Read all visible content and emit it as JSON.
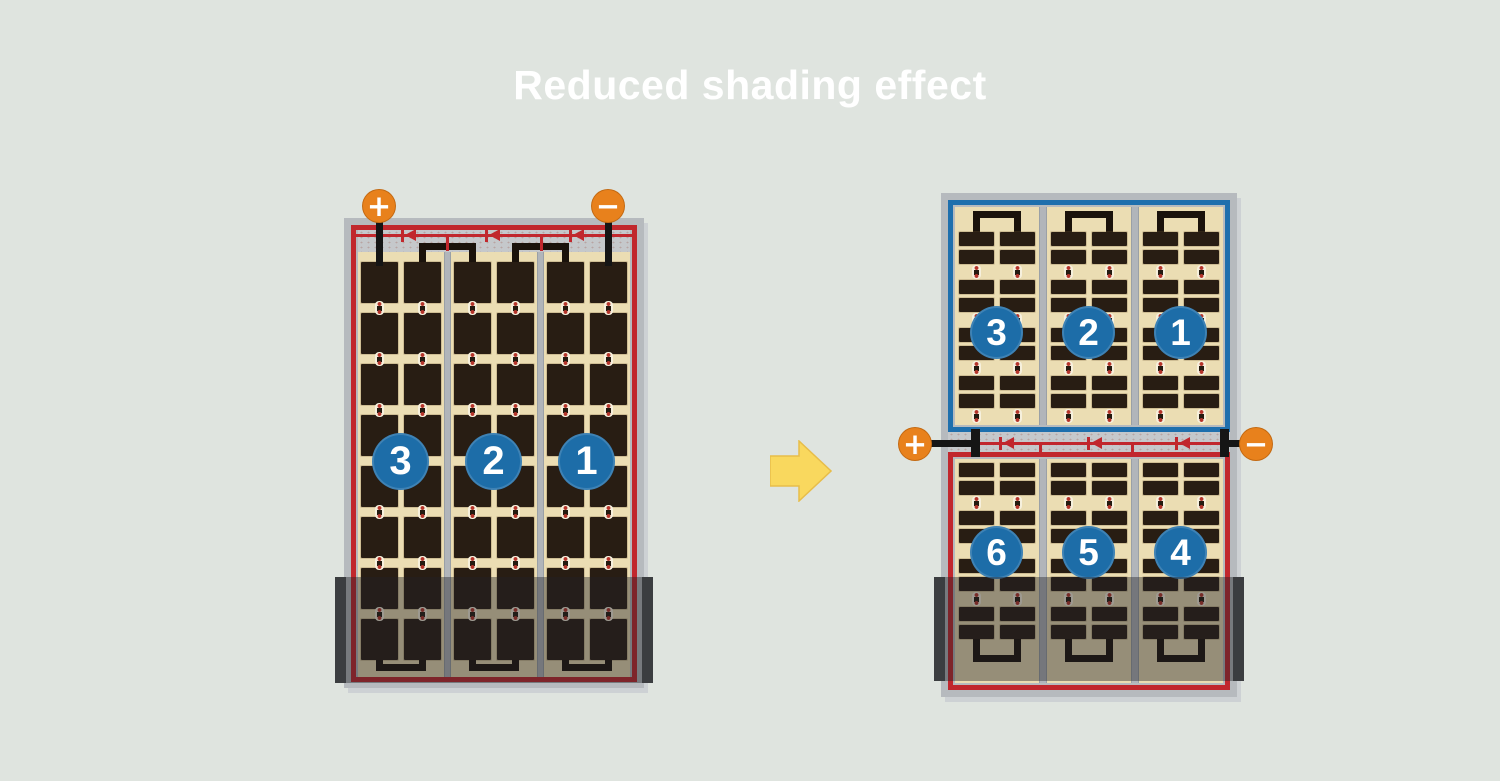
{
  "title": "Reduced shading effect",
  "left_panel": {
    "terminal_positive": "+",
    "terminal_negative": "−",
    "strings": [
      {
        "number": "3"
      },
      {
        "number": "2"
      },
      {
        "number": "1"
      }
    ],
    "shaded_rows": "bottom"
  },
  "right_panel": {
    "terminal_positive": "+",
    "terminal_negative": "−",
    "top_half_strings": [
      {
        "number": "3"
      },
      {
        "number": "2"
      },
      {
        "number": "1"
      }
    ],
    "bottom_half_strings": [
      {
        "number": "6"
      },
      {
        "number": "5"
      },
      {
        "number": "4"
      }
    ],
    "shaded_rows": "bottom"
  },
  "colors": {
    "background": "#dfe4df",
    "title_color": "#ffffff",
    "frame": "#b6babe",
    "strip": "#c5c8cb",
    "cream": "#ebddb3",
    "cell": "#281d13",
    "busbar": "#b1b5ba",
    "bus": "#1a120b",
    "stem": "#151515",
    "red_wire": "#c1272d",
    "blue_wire": "#1e6fad",
    "string_badge": "#1d6da8",
    "terminal": "#e8811c",
    "arrow_fill": "#f9d85e",
    "arrow_stroke": "#e7bd4a",
    "shading": "rgba(33,34,38,0.42)",
    "shade_bar": "#3b3d40"
  }
}
